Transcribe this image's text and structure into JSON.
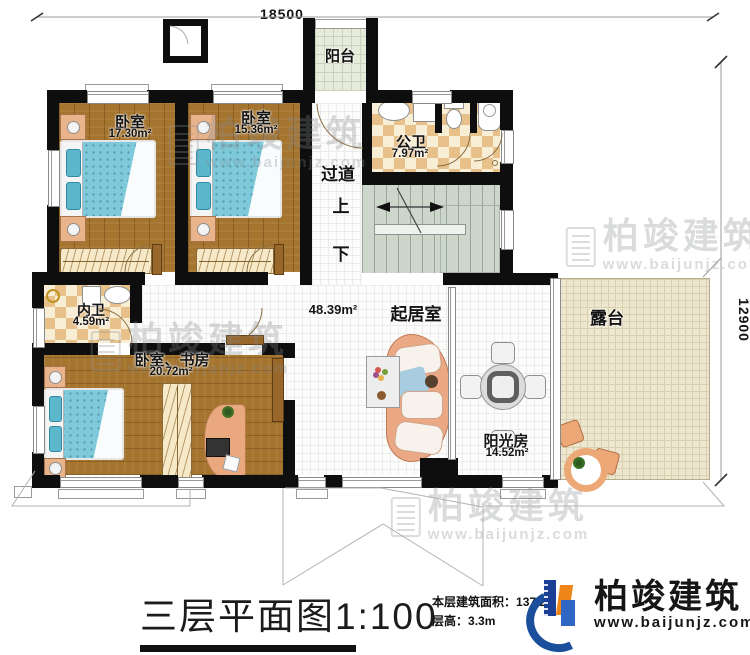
{
  "dimensions": {
    "top": "18500",
    "right": "12900"
  },
  "rooms": {
    "balcony": {
      "label": "阳台"
    },
    "bedroom1": {
      "label": "卧室",
      "area": "17.30m²"
    },
    "bedroom2": {
      "label": "卧室",
      "area": "15.36m²"
    },
    "public_bath": {
      "label": "公卫",
      "area": "7.97m²"
    },
    "corridor": {
      "label": "过道"
    },
    "inner_bath": {
      "label": "内卫",
      "area": "4.59m²"
    },
    "bedroom_study": {
      "label": "卧室、书房",
      "area": "20.72m²"
    },
    "living": {
      "label": "起居室",
      "area": "48.39m²"
    },
    "sunroom": {
      "label": "阳光房",
      "area": "14.52m²"
    },
    "terrace": {
      "label": "露台"
    }
  },
  "stairs": {
    "up": "上",
    "down": "下"
  },
  "title": {
    "text": "三层平面图",
    "scale": "1:100"
  },
  "stats": {
    "area_label": "本层建筑面积：",
    "area_value": "137.2",
    "height_label": "层高：",
    "height_value": "3.3m"
  },
  "brand": {
    "name": "柏竣建筑",
    "website": "www.baijunjz.com"
  },
  "watermark": {
    "name": "柏竣建筑",
    "website": "www.baijunjz.com"
  }
}
